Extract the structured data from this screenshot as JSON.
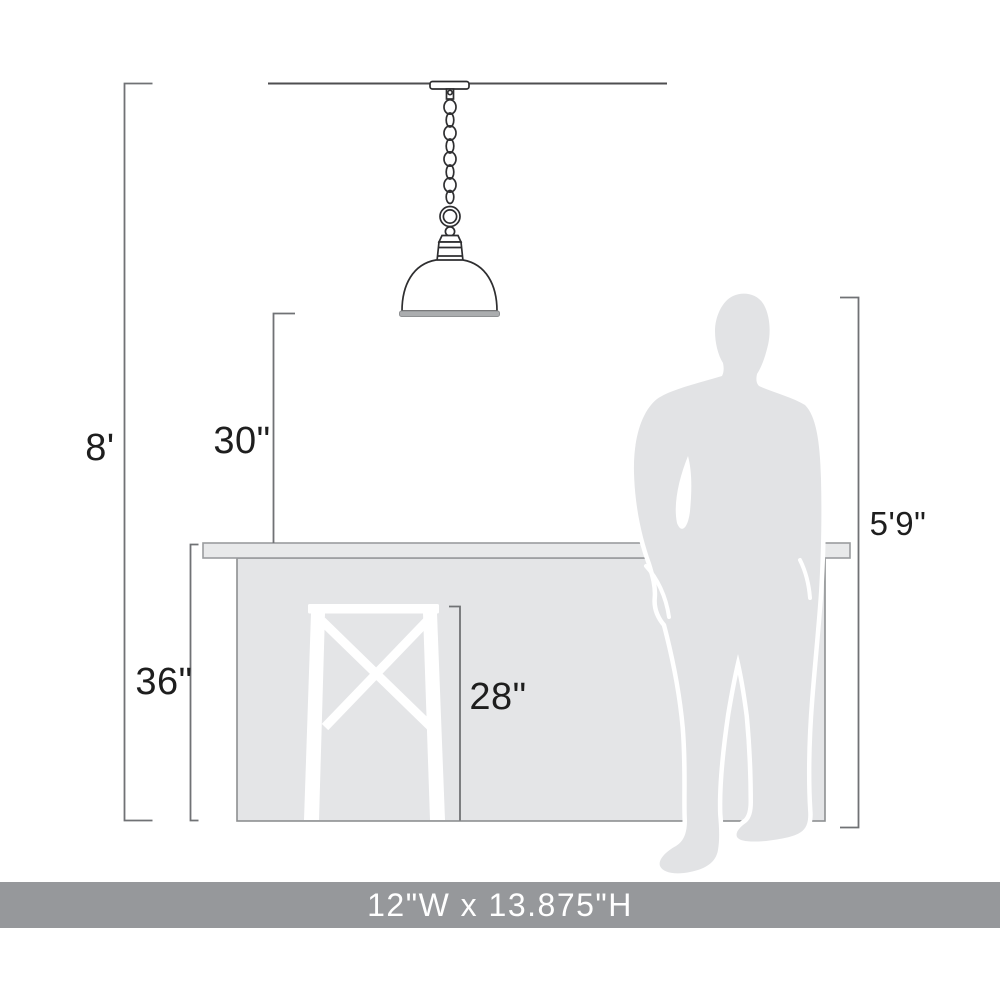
{
  "footer": {
    "size_label": "12\"W x 13.875\"H"
  },
  "dimension_labels": {
    "ceiling_height": "8'",
    "pendant_bottom_to_counter": "30\"",
    "counter_height": "36\"",
    "stool_seat_height": "28\"",
    "person_height": "5'9\""
  },
  "colors": {
    "footer-band": "#96989B",
    "footer-text": "#FFFFFF",
    "island-fill": "#E4E5E7",
    "island-stroke": "#8D8F91",
    "counter-fill": "#E8E9EA",
    "counter-stroke": "#9A9C9E",
    "person-fill": "#E2E3E5",
    "person-outline": "#FFFFFF",
    "dimension-line": "#707275",
    "drawing-stroke": "#2E2E30",
    "label-text": "#1E1E1E"
  }
}
